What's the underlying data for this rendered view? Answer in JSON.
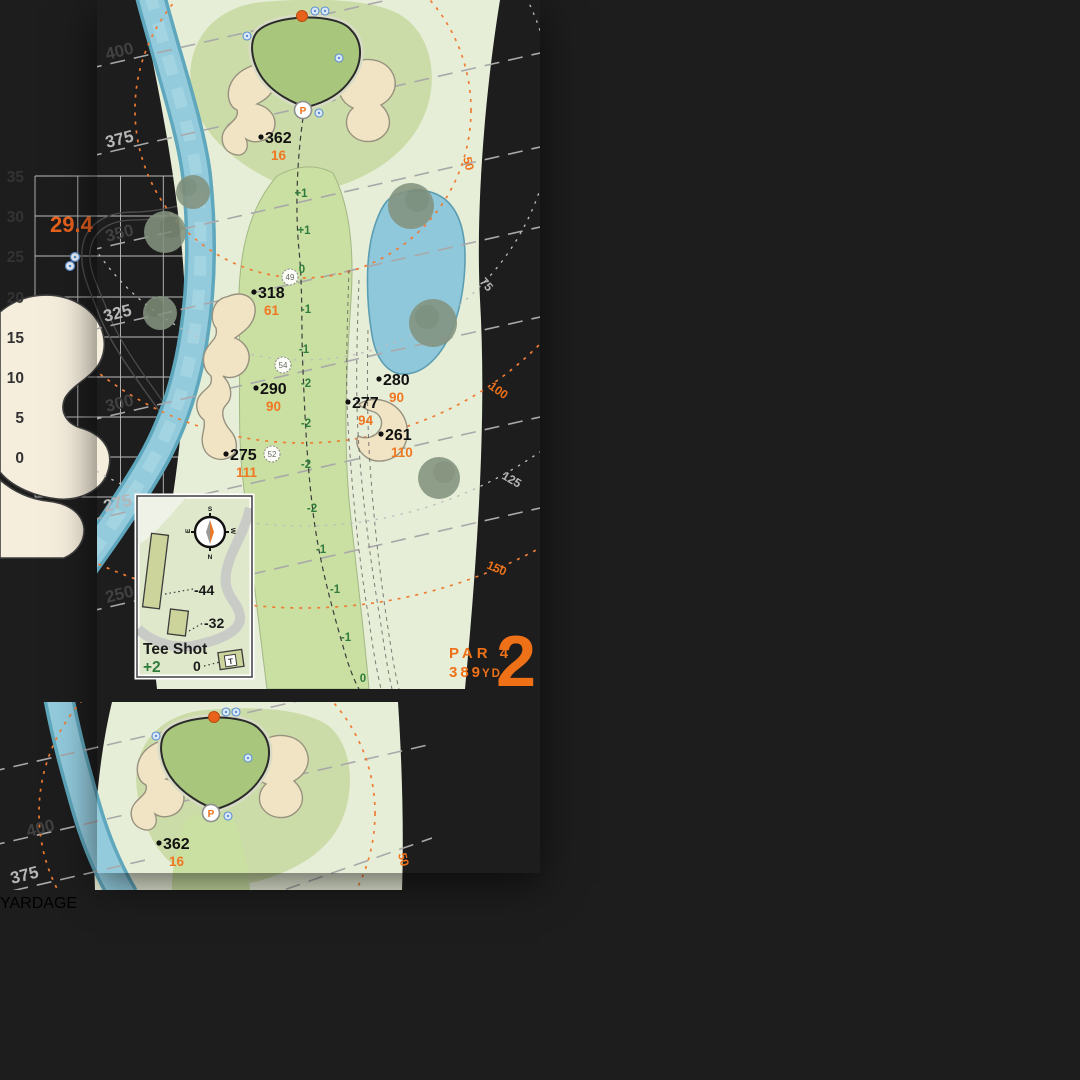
{
  "banner": {
    "title": "YARDAGE",
    "color": "#f4721b"
  },
  "compass": {
    "n": "N",
    "s": "S",
    "e": "E",
    "w": "W"
  },
  "left": {
    "par_label": "PAR 4",
    "yards": "389",
    "yards_unit": "YD",
    "hole_number": "2",
    "pin_letter": "P",
    "distance_labels": [
      "400",
      "375",
      "350",
      "325",
      "300",
      "275",
      "250"
    ],
    "arc_labels": [
      "50",
      "75",
      "100",
      "125",
      "150"
    ],
    "markers": [
      {
        "carry": "362",
        "pin": "16"
      },
      {
        "carry": "318",
        "pin": "61"
      },
      {
        "carry": "290",
        "pin": "90"
      },
      {
        "carry": "277",
        "pin": "94"
      },
      {
        "carry": "280",
        "pin": "90"
      },
      {
        "carry": "261",
        "pin": "110"
      },
      {
        "carry": "275",
        "pin": "111"
      }
    ],
    "elevations": [
      "+1",
      "+1",
      "0",
      "-1",
      "-1",
      "-2",
      "-2",
      "-2",
      "-2",
      "-1",
      "-1",
      "-1",
      "0"
    ],
    "circled": [
      "49",
      "54",
      "52"
    ],
    "inset": {
      "title": "Tee Shot",
      "score": "+2",
      "back": "-44",
      "mid": "-32",
      "zero": "0",
      "tee": "T"
    }
  },
  "right": {
    "front_depth": "29.4",
    "pin_letter": "P",
    "ticks": [
      "35",
      "30",
      "25",
      "20",
      "15",
      "10",
      "5",
      "0"
    ]
  },
  "under": {
    "d400": "400",
    "d375": "375",
    "arc50": "50",
    "marker": {
      "carry": "362",
      "pin": "16"
    }
  },
  "colors": {
    "accent_orange": "#f4721b",
    "map_orange": "#ee7118",
    "arc_orange": "#ef7c33",
    "elevation_green": "#2f7c3c",
    "water": "#8fc8db",
    "sand": "#f1e4c4"
  }
}
